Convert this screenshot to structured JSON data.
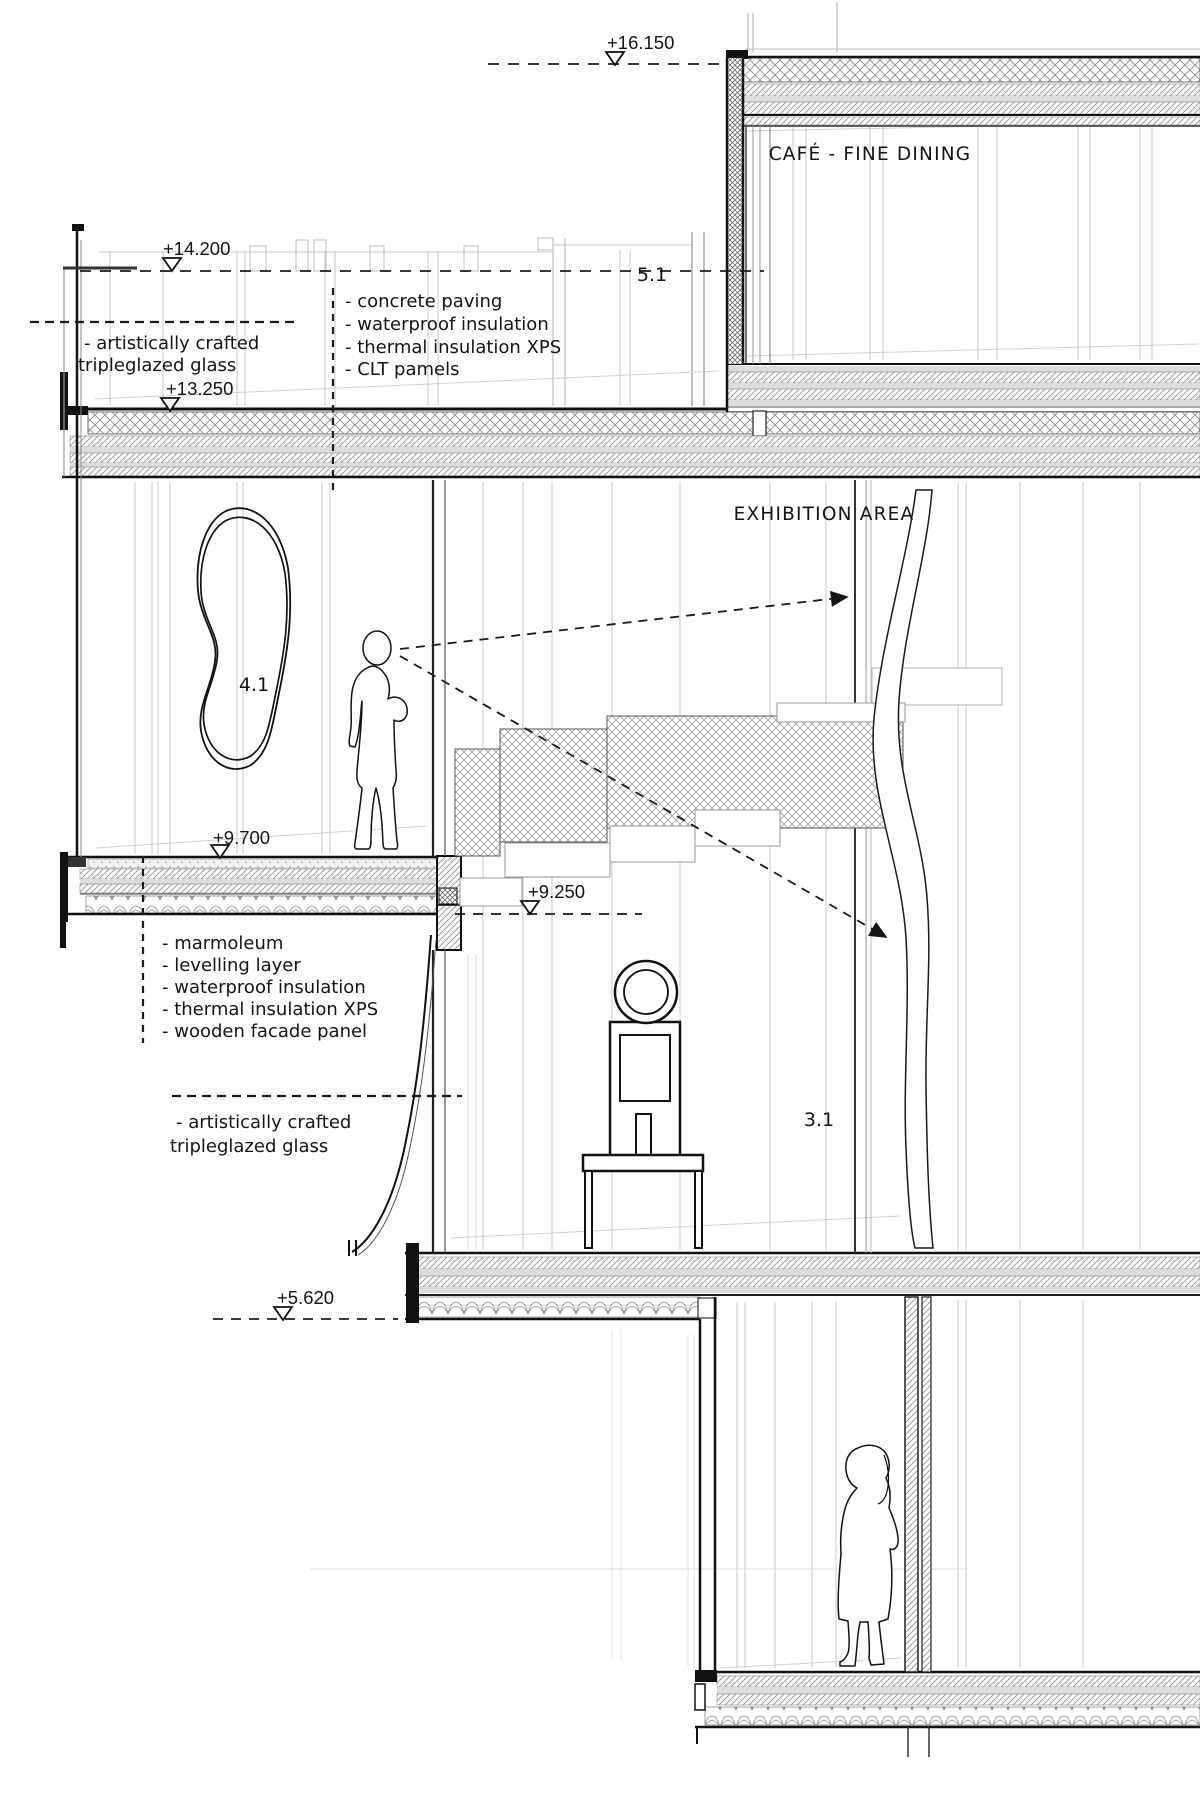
{
  "levels": {
    "l1": "+16.150",
    "l2": "+14.200",
    "l3": "+13.250",
    "l4": "+9.700",
    "l5": "+9.250",
    "l6": "+5.620"
  },
  "rooms": {
    "cafe": "CAFÉ - FINE DINING",
    "exhibition": "EXHIBITION AREA",
    "r51": "5.1",
    "r41": "4.1",
    "r31": "3.1"
  },
  "notes": {
    "roof_assembly": [
      "- concrete paving",
      "- waterproof insulation",
      "- thermal insulation XPS",
      "- CLT pamels"
    ],
    "floor_assembly": [
      "- marmoleum",
      "- levelling layer",
      "- waterproof insulation",
      "- thermal insulation XPS",
      "- wooden facade panel"
    ],
    "glazing": [
      "- artistically crafted",
      "tripleglazed glass"
    ]
  }
}
